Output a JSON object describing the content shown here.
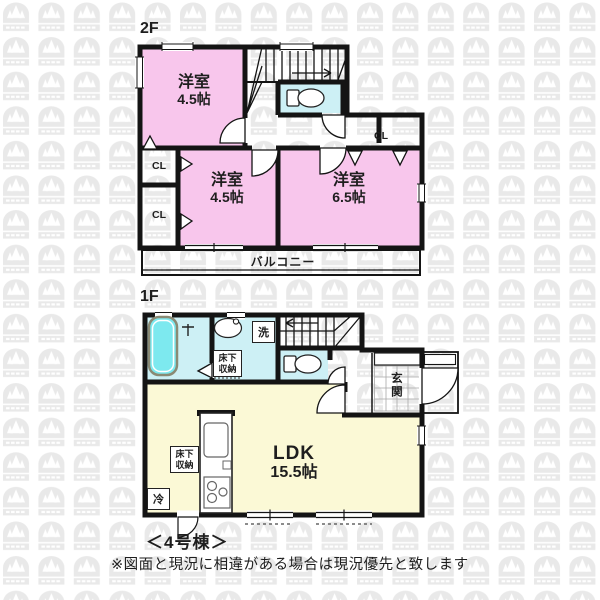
{
  "floor2": {
    "label": "2F",
    "rooms": {
      "tl": {
        "name": "洋室",
        "size": "4.5帖"
      },
      "bm": {
        "name": "洋室",
        "size": "4.5帖"
      },
      "br": {
        "name": "洋室",
        "size": "6.5帖"
      }
    },
    "closets": {
      "left_top": "CL",
      "left_bottom": "CL",
      "right": "CL"
    },
    "balcony_label": "バルコニー"
  },
  "floor1": {
    "label": "1F",
    "ldk": {
      "name": "LDK",
      "size": "15.5帖"
    },
    "genkan_label": "玄関",
    "washer_label": "洗",
    "fridge_label": "冷",
    "storage_washroom": "床下収納",
    "storage_kitchen": "床下収納"
  },
  "footer": {
    "building_label": "＜4号棟＞",
    "note": "※図面と現況に相違がある場合は現況優先と致します"
  },
  "colors": {
    "room_pink": "#f8c6ec",
    "wet_cyan": "#cdf0f5",
    "ldk_yellow": "#fbf9d6",
    "tub_cyan": "#7de9ef",
    "wall": "#141414",
    "watermark": "#e9e9e9"
  }
}
